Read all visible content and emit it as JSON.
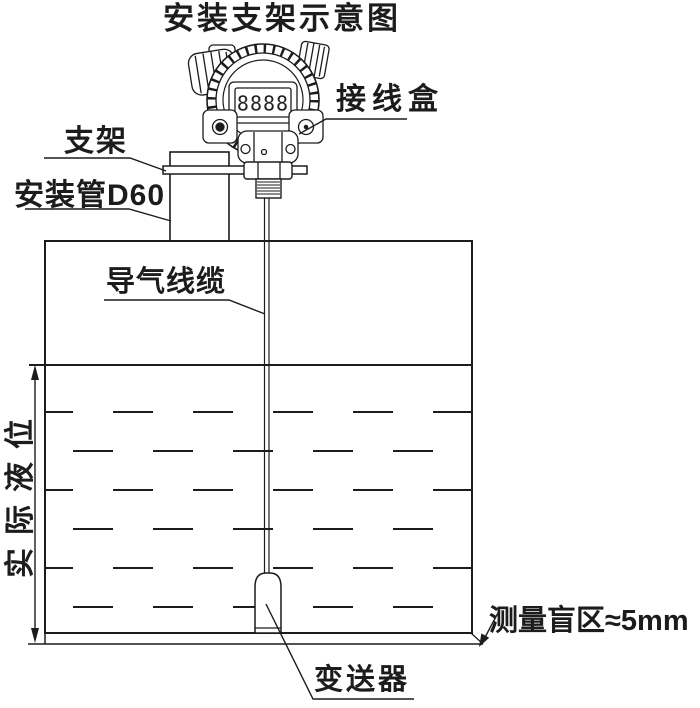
{
  "title": "安装支架示意图",
  "instrument": {
    "display_value": "8888"
  },
  "labels": {
    "junction_box": "接线盒",
    "bracket": "支架",
    "mounting_pipe": "安装管D60",
    "air_cable": "导气线缆",
    "actual_level": "实际液位",
    "blind_zone": "测量盲区≈5mm",
    "transmitter": "变送器"
  },
  "colors": {
    "line": "#1c1c1c",
    "background": "#ffffff"
  }
}
